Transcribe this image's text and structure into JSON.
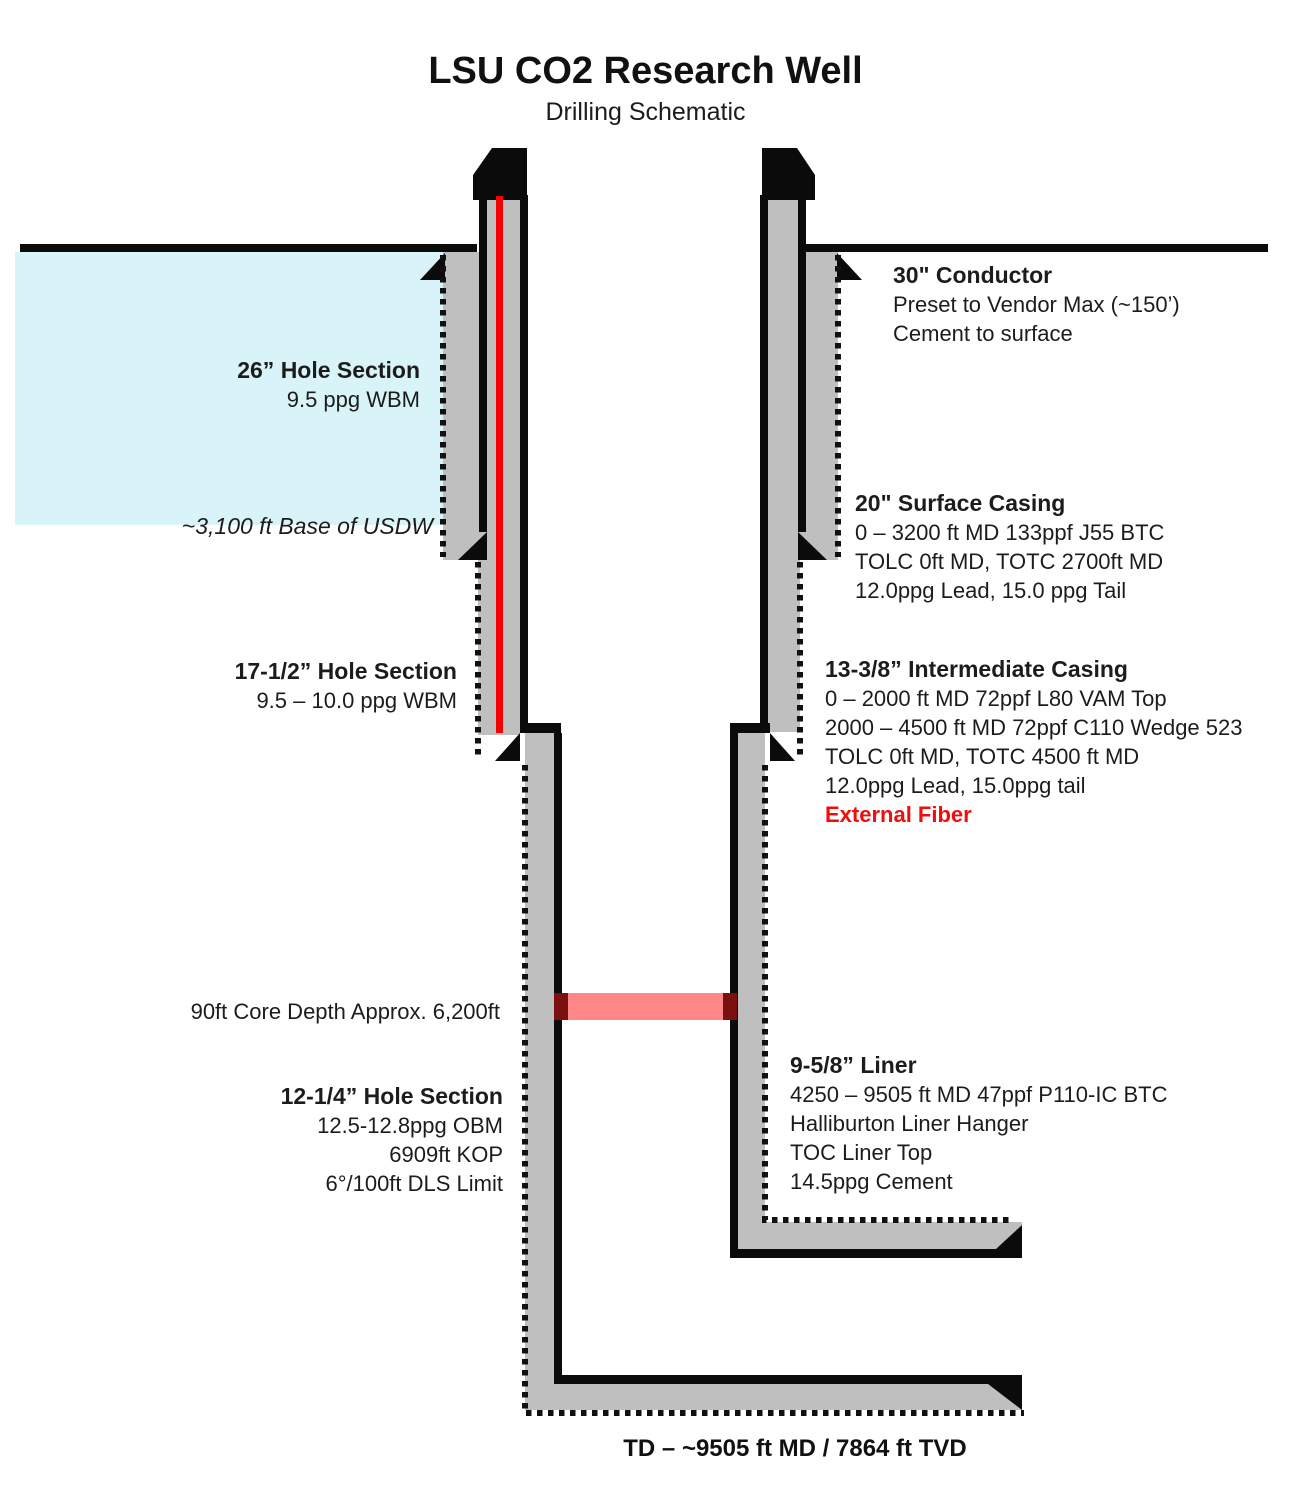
{
  "title": "LSU CO2 Research Well",
  "subtitle": "Drilling Schematic",
  "colors": {
    "gray_fill": "#bfbfbf",
    "usdw_blue": "#d9f4f8",
    "fiber_red": "#f30000",
    "core_pink": "#ff8787",
    "core_dark_red": "#7a1010",
    "highlight_text_red": "#f20d0d",
    "line_black": "#0b0b0b"
  },
  "labels": {
    "conductor": {
      "title": "30\" Conductor",
      "lines": [
        "Preset to Vendor Max (~150’)",
        "Cement to surface"
      ]
    },
    "hole26": {
      "title": "26” Hole Section",
      "lines": [
        "9.5 ppg WBM"
      ]
    },
    "usdw": {
      "text": "~3,100 ft Base of USDW"
    },
    "surface_casing": {
      "title": "20\" Surface Casing",
      "lines": [
        "0 – 3200 ft MD 133ppf J55 BTC",
        "TOLC 0ft MD, TOTC 2700ft MD",
        "12.0ppg Lead, 15.0 ppg Tail"
      ]
    },
    "hole17": {
      "title": "17-1/2” Hole Section",
      "lines": [
        "9.5 – 10.0 ppg WBM"
      ]
    },
    "intermediate_casing": {
      "title": "13-3/8” Intermediate Casing",
      "lines": [
        "0 – 2000 ft MD 72ppf L80 VAM Top",
        "2000 – 4500 ft MD 72ppf C110 Wedge 523",
        "TOLC 0ft MD, TOTC 4500 ft MD",
        "12.0ppg Lead, 15.0ppg tail"
      ],
      "highlight": "External Fiber"
    },
    "core": {
      "text": "90ft Core Depth Approx. 6,200ft"
    },
    "hole12": {
      "title": "12-1/4” Hole Section",
      "lines": [
        "12.5-12.8ppg OBM",
        "6909ft KOP",
        "6°/100ft DLS Limit"
      ]
    },
    "liner": {
      "title": "9-5/8” Liner",
      "lines": [
        "4250 – 9505 ft MD 47ppf P110-IC BTC",
        "Halliburton Liner Hanger",
        "TOC Liner Top",
        "14.5ppg Cement"
      ]
    },
    "td": {
      "text": "TD – ~9505 ft MD / 7864 ft TVD"
    }
  }
}
